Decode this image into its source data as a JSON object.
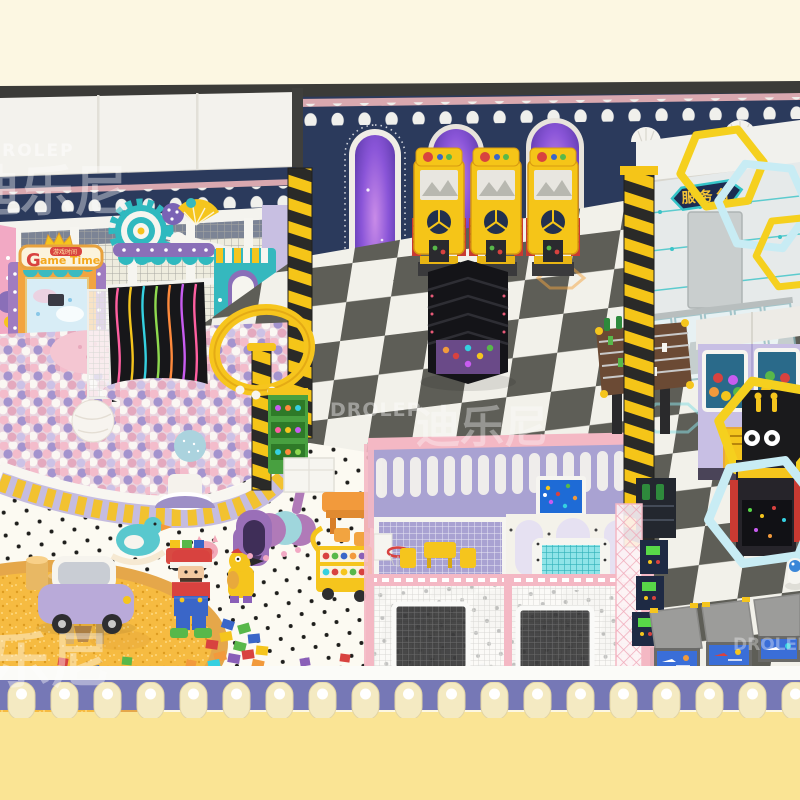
{
  "scene": {
    "description": "3D render of an indoor children's playground with ball pit, arcade machines, trampoline court, sand pit and service counter"
  },
  "watermarks": {
    "brand": "DROLEP",
    "brand_cn": "迪乐尼"
  },
  "signs": {
    "game_time": {
      "g": "G",
      "ame": "ame",
      "time": "Time",
      "badge_cn": "游戏时间"
    },
    "service_desk_cn": "服务台"
  },
  "palette": {
    "cream": "#FCF7E2",
    "fg-yellow": "#FAE494",
    "trim-purple": "#7678B6",
    "trim-tab": "#F4EAC2",
    "navy": "#2B3A5C",
    "stripe-pink": "#D9A8AF",
    "checker-dark": "#5E5E57",
    "checker-light": "#F2F1EA",
    "polka-bg": "#FCFAF2",
    "arcade-yellow": "#F5C518",
    "teal": "#35B8BE",
    "orange": "#F2A440",
    "ring-yellow": "#F6C51D",
    "fence-pink": "#F4B8C4",
    "mesh-purple": "#A9A2D2",
    "ball-pink": "#F3BCCB",
    "ball-purple": "#A494CE",
    "ball-white": "#FAF7F3",
    "sand": "#F6BB41",
    "sand-rim": "#E5A74A",
    "counter-body": "#E6EAEA",
    "hex-yellow": "#F5D01E",
    "hex-cyan": "#C8ECF4",
    "claw-lilac": "#C8BFE4",
    "game-red": "#D8423F",
    "white": "#F2F1EC"
  }
}
